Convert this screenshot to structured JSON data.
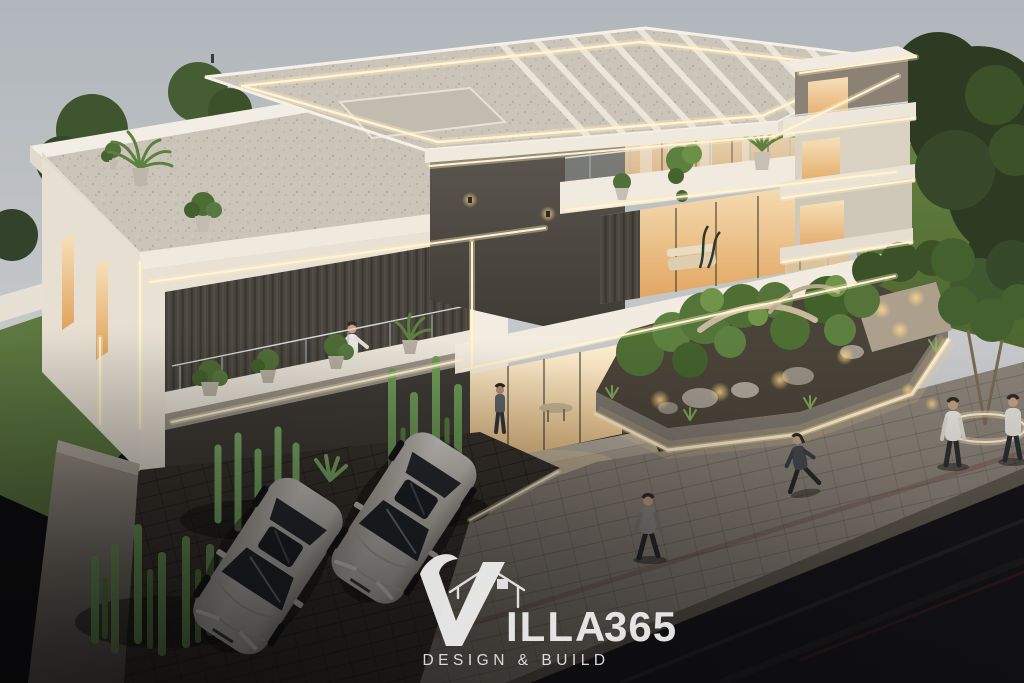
{
  "watermark": {
    "brand": "VILLA 365",
    "brand_initial": "V",
    "brand_rest": "ILLA",
    "brand_number": "365",
    "tagline": "DESIGN & BUILD",
    "icon": "house-outline-icon",
    "text_color": "#f2f2f2"
  },
  "palette": {
    "sky_top": "#b2b8bd",
    "sky_bottom": "#cbcdce",
    "hill_green": "#617e3c",
    "tree_dark": "#2e3c24",
    "lawn_green": "#5d7840",
    "facade_white": "#f1ebe1",
    "facade_shade": "#ddd5c6",
    "feature_wall": "#534e47",
    "slat_wall": "#49453e",
    "wood_slat": "#8a7a5f",
    "gravel_roof": "#cac4b7",
    "window_warm": "#f3d3a0",
    "window_deep": "#dfa55e",
    "led_light": "#fff4d6",
    "glass_rail": "#c7d4d6",
    "zen_foliage": "#55743a",
    "cactus_green": "#6f9c58",
    "stone_rock": "#a29b8e",
    "planter_wall": "#797368",
    "sidewalk": "#8b8378",
    "driveway": "#38322b",
    "road": "#141417",
    "car_body": "#d7d3cc",
    "car_glass": "#202428"
  },
  "scene": {
    "setting": "modern villa exterior render at dusk",
    "objects": [
      "grey-dusk-sky",
      "green-hillside",
      "dark-corner-trees",
      "roof-terrace-with-planters",
      "led-pergola-roof",
      "dark-feature-wall",
      "warm-lit-glass-interiors",
      "balcony-with-plants",
      "right-annex-building",
      "entrance-glass-doors",
      "zen-garden-planter",
      "rocks-and-driftwood",
      "cactus-beds",
      "boundary-walls",
      "paved-driveway",
      "two-white-sedans",
      "stone-sidewalk",
      "asphalt-road",
      "pedestrians",
      "brand-watermark"
    ]
  }
}
